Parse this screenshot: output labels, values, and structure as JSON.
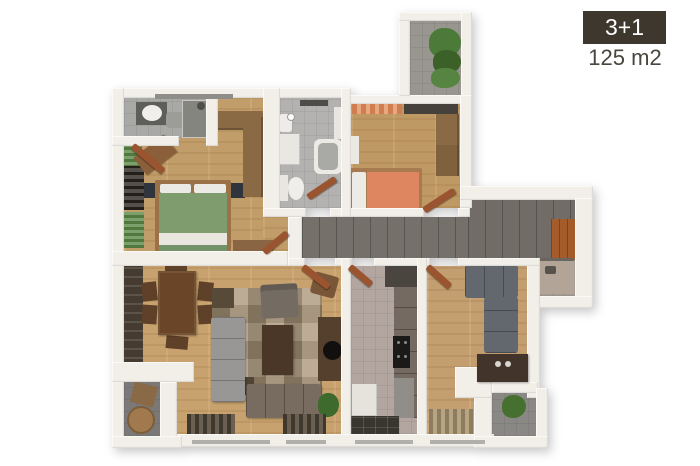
{
  "badge": {
    "label": "3+1"
  },
  "area_label": "125 m2",
  "colors": {
    "badge_bg": "#3e372e",
    "badge_text": "#ffffff",
    "area_text": "#4a453e",
    "wall": "#f2efe9",
    "wood_floor": "#c9a46e",
    "corridor_floor": "#6f6a64",
    "bath_floor": "#b3b2b0",
    "kitchen_floor": "#b3a6a0",
    "balcony_floor": "#82807d",
    "green_bed": "#7e9c6e",
    "orange_bed": "#dd8660",
    "sofa_gray": "#565c63",
    "rug": "#ab977b",
    "cabinet_wood": "#8a6a44"
  },
  "rooms": [
    "master-bedroom",
    "ensuite-bathroom",
    "bathroom",
    "bedroom",
    "kids-room",
    "living-room",
    "kitchen",
    "hallway",
    "balcony-top",
    "balcony-bottom-left",
    "balcony-bottom-right"
  ]
}
